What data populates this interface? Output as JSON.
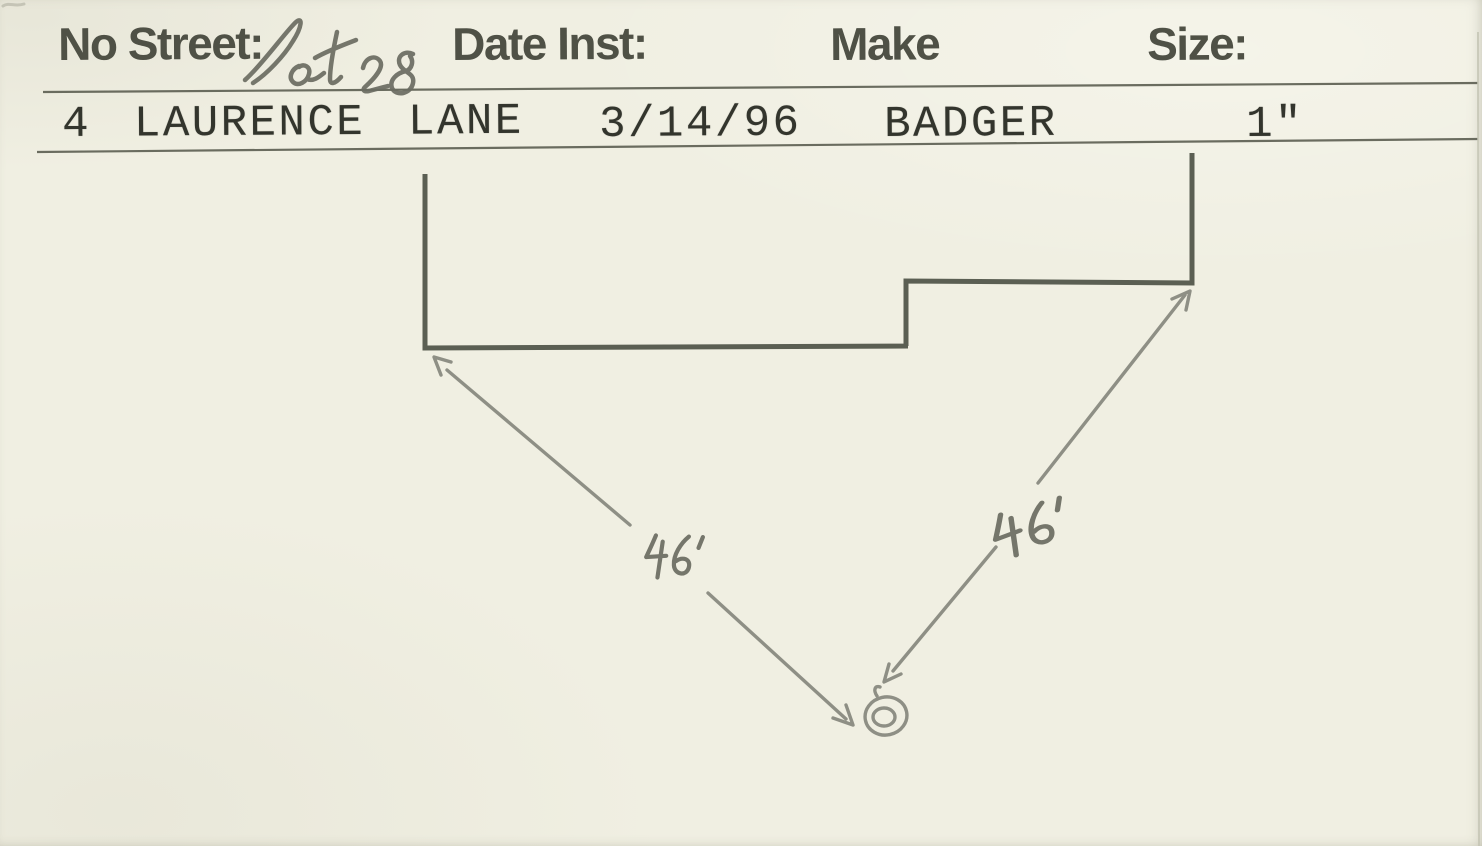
{
  "header": {
    "fields": [
      {
        "id": "no-street",
        "label": "No Street:",
        "handwritten_value": "lot 28",
        "typed_value": "4 LAURENCE LANE"
      },
      {
        "id": "date-inst",
        "label": "Date Inst:",
        "typed_value": "3/14/96"
      },
      {
        "id": "make",
        "label": "Make",
        "typed_value": "BADGER"
      },
      {
        "id": "size",
        "label": "Size:",
        "typed_value": "1\""
      }
    ]
  },
  "diagram": {
    "kind": "hand-drawn-site-sketch",
    "shapes": [
      "stepped-house-front-outline",
      "double-circle-service-point"
    ],
    "measurements": [
      {
        "label": "46'",
        "from": "house-left-corner",
        "to": "service-point"
      },
      {
        "label": "46'",
        "from": "service-point",
        "to": "house-right-corner"
      }
    ]
  },
  "colors": {
    "paper": "#f0efe2",
    "rule_line": "#6a6c5f",
    "printed_ink": "#4f5146",
    "typed_ink": "#33352d",
    "pencil_dark": "#5b5f53",
    "pencil_light": "#8e8f85"
  }
}
